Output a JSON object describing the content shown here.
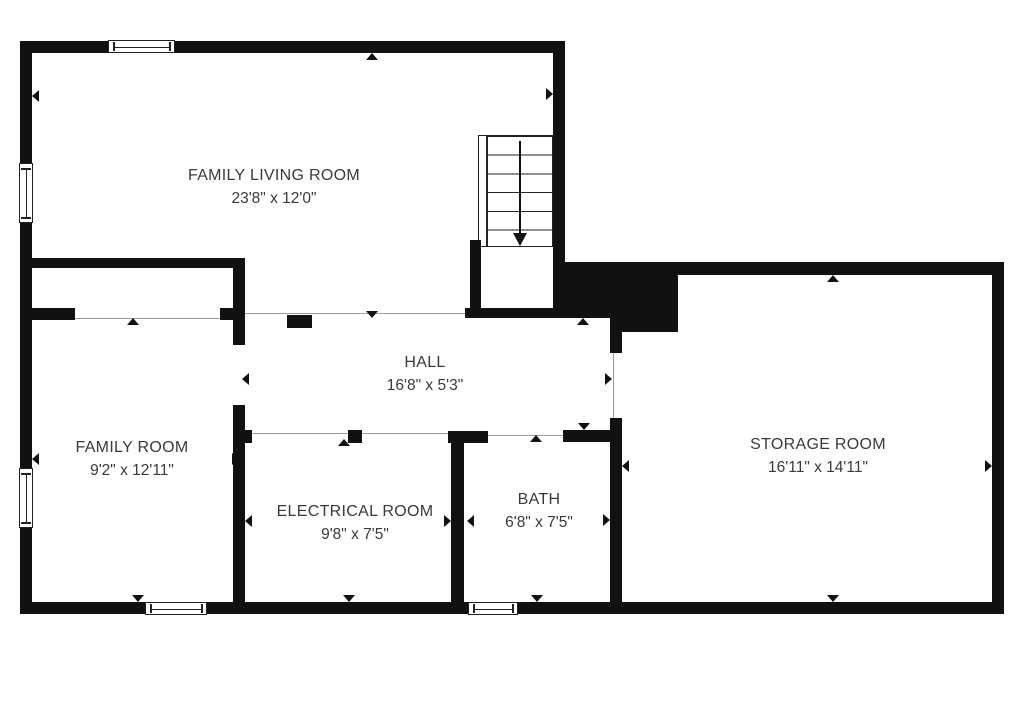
{
  "plan": {
    "rooms": [
      {
        "id": "family-living-room",
        "name": "FAMILY LIVING ROOM",
        "dims": "23'8\" x 12'0\""
      },
      {
        "id": "hall",
        "name": "HALL",
        "dims": "16'8\" x 5'3\""
      },
      {
        "id": "family-room",
        "name": "FAMILY ROOM",
        "dims": "9'2\" x 12'11\""
      },
      {
        "id": "electrical-room",
        "name": "ELECTRICAL ROOM",
        "dims": "9'8\" x 7'5\""
      },
      {
        "id": "bath",
        "name": "BATH",
        "dims": "6'8\" x 7'5\""
      },
      {
        "id": "storage-room",
        "name": "STORAGE ROOM",
        "dims": "16'11\" x 14'11\""
      }
    ],
    "stairs": {
      "direction": "down",
      "tread_count": 6
    },
    "window_count": 5,
    "colors": {
      "wall": "#111111",
      "text": "#3a3a3a",
      "opening_line": "#999999",
      "background": "#ffffff"
    }
  }
}
